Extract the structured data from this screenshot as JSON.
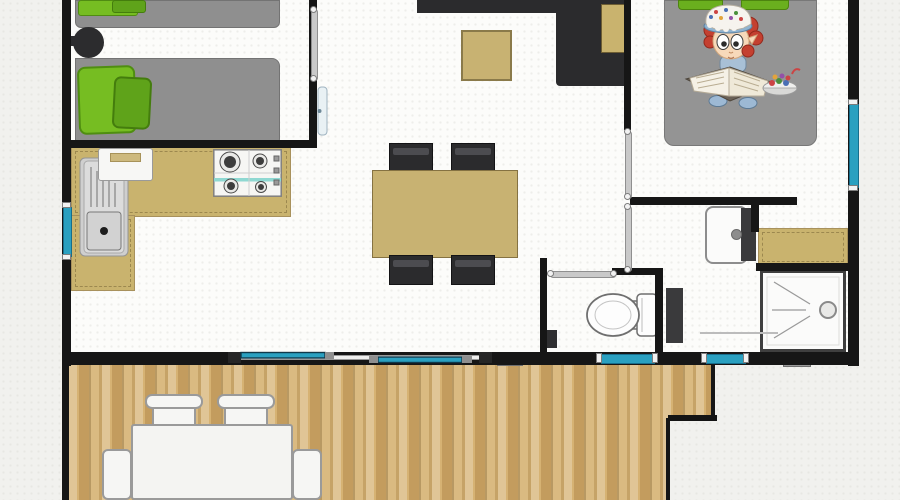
{
  "canvas": {
    "w": 900,
    "h": 500,
    "background": "#f1f1ee"
  },
  "palette": {
    "wall": "#161616",
    "floor": "#fcfcfa",
    "counter_tan": "#c9b36e",
    "table_tan": "#c8b272",
    "sofa_dark": "#2b2b2d",
    "bed_gray": "#8f8f8f",
    "pillow_green": "#76bd22",
    "pillow_green_dark": "#5fa31a",
    "window_cyan": "#2aa0c0",
    "deck_wood": "#d6b273",
    "fixture_white": "#fbfbfa",
    "fixture_dark": "#3a3a3c"
  },
  "layers": [
    {
      "name": "floor",
      "items": [
        {
          "n": "interior-floor",
          "t": "rect",
          "x": 66,
          "y": 0,
          "w": 786,
          "h": 358,
          "cls": "floor"
        }
      ]
    },
    {
      "name": "furniture",
      "items": [
        {
          "n": "kitchen-counter-top",
          "t": "rect",
          "x": 71,
          "y": 147,
          "w": 220,
          "h": 70,
          "c": "#c9b36e",
          "b": "1px solid #a8915c",
          "cls": "dashes"
        },
        {
          "n": "kitchen-counter-left",
          "t": "rect",
          "x": 71,
          "y": 215,
          "w": 64,
          "h": 76,
          "c": "#c9b36e",
          "b": "1px solid #a8915c",
          "cls": "dashes"
        },
        {
          "n": "kitchen-sink",
          "t": "sink",
          "x": 79,
          "y": 157,
          "w": 50,
          "h": 100
        },
        {
          "n": "kitchen-cabinet-white",
          "t": "appliance",
          "x": 98,
          "y": 148,
          "w": 55,
          "h": 33,
          "c": "#f7f7f5",
          "b": "1px solid #9a9a9a",
          "r": "3px"
        },
        {
          "n": "gas-hob",
          "t": "stove",
          "x": 213,
          "y": 149,
          "w": 69,
          "h": 48
        },
        {
          "n": "dining-chair-1",
          "t": "chair",
          "x": 389,
          "y": 143,
          "w": 44,
          "h": 30
        },
        {
          "n": "dining-chair-2",
          "t": "chair",
          "x": 451,
          "y": 143,
          "w": 44,
          "h": 30
        },
        {
          "n": "dining-table",
          "t": "rect",
          "x": 372,
          "y": 170,
          "w": 146,
          "h": 88,
          "c": "#c8b272",
          "b": "1px solid #857242"
        },
        {
          "n": "dining-chair-3",
          "t": "chair",
          "x": 389,
          "y": 255,
          "w": 44,
          "h": 30
        },
        {
          "n": "dining-chair-4",
          "t": "chair",
          "x": 451,
          "y": 255,
          "w": 44,
          "h": 30
        },
        {
          "n": "sofa-back",
          "t": "rect",
          "x": 417,
          "y": 0,
          "w": 214,
          "h": 13,
          "c": "#2b2b2d",
          "cls": "speckle-dark"
        },
        {
          "n": "sofa-chaise",
          "t": "rect",
          "x": 556,
          "y": 11,
          "w": 75,
          "h": 75,
          "c": "#2b2b2d",
          "cls": "speckle-dark",
          "r": "0 0 0 4px"
        },
        {
          "n": "sofa-side-table",
          "t": "rect",
          "x": 601,
          "y": 4,
          "w": 29,
          "h": 49,
          "c": "#c9b36e",
          "b": "1px solid #6d5d33"
        },
        {
          "n": "coffee-table",
          "t": "rect",
          "x": 461,
          "y": 30,
          "w": 51,
          "h": 51,
          "c": "#c8b272",
          "b": "2px solid #8a7a4a"
        },
        {
          "n": "bed-single-top",
          "t": "rect",
          "x": 75,
          "y": 0,
          "w": 205,
          "h": 28,
          "c": "#8f8f8f",
          "b": "1px solid #737373",
          "r": "0 0 6px 6px",
          "cls": "speckle-gray"
        },
        {
          "n": "pillow-top-a",
          "t": "rect",
          "x": 78,
          "y": 0,
          "w": 60,
          "h": 16,
          "c": "#76bd22",
          "b": "1px solid #508c12",
          "r": "3px"
        },
        {
          "n": "pillow-top-b",
          "t": "rect",
          "x": 112,
          "y": 0,
          "w": 34,
          "h": 13,
          "c": "#5fa31a",
          "b": "1px solid #447d0d",
          "r": "3px"
        },
        {
          "n": "bedside-stool-arm",
          "t": "rect",
          "x": 66,
          "y": 36,
          "w": 10,
          "h": 10,
          "c": "#2c2c2e"
        },
        {
          "n": "bedside-stool",
          "t": "rect",
          "x": 73,
          "y": 27,
          "w": 31,
          "h": 31,
          "c": "#2c2c2e",
          "r": "50%",
          "cls": "speckle-dark"
        },
        {
          "n": "bed-single-bottom",
          "t": "rect",
          "x": 75,
          "y": 58,
          "w": 205,
          "h": 89,
          "c": "#8f8f8f",
          "b": "1px solid #737373",
          "r": "0 8px 8px 0",
          "cls": "speckle-gray"
        },
        {
          "n": "pillow-bottom-a",
          "t": "rect",
          "x": 78,
          "y": 66,
          "w": 58,
          "h": 68,
          "c": "#76bd22",
          "b": "2px solid #4f8e10",
          "r": "8px",
          "rot": -2
        },
        {
          "n": "pillow-bottom-b",
          "t": "rect",
          "x": 113,
          "y": 77,
          "w": 38,
          "h": 52,
          "c": "#5fa31a",
          "b": "2px solid #447d0d",
          "r": "7px",
          "rot": 3
        },
        {
          "n": "bed-double",
          "t": "rect",
          "x": 664,
          "y": 0,
          "w": 153,
          "h": 146,
          "c": "#949494",
          "b": "1px solid #787878",
          "r": "0 0 10px 10px",
          "cls": "speckle-gray"
        },
        {
          "n": "pillow-double-a",
          "t": "rect",
          "x": 678,
          "y": 0,
          "w": 45,
          "h": 10,
          "c": "#6aaf1e",
          "b": "1px solid #4d840f",
          "r": "0 0 4px 4px"
        },
        {
          "n": "pillow-double-b",
          "t": "rect",
          "x": 741,
          "y": 0,
          "w": 48,
          "h": 10,
          "c": "#6aaf1e",
          "b": "1px solid #4d840f",
          "r": "0 0 4px 4px"
        },
        {
          "n": "washbasin",
          "t": "rect",
          "x": 705,
          "y": 206,
          "w": 43,
          "h": 58,
          "c": "#fbfbfa",
          "b": "2px solid #8d8d8d",
          "r": "8px"
        },
        {
          "n": "washbasin-vanity",
          "t": "rect",
          "x": 741,
          "y": 208,
          "w": 15,
          "h": 53,
          "c": "#3a3a3c"
        },
        {
          "n": "washbasin-tap",
          "t": "rect",
          "x": 731,
          "y": 229,
          "w": 11,
          "h": 11,
          "c": "#8d8d8d",
          "r": "50%",
          "b": "1px solid #6a6a6a"
        },
        {
          "n": "bathroom-counter",
          "t": "rect",
          "x": 758,
          "y": 228,
          "w": 90,
          "h": 38,
          "c": "#c9b36e",
          "b": "1px solid #a8915c",
          "cls": "dashes"
        },
        {
          "n": "shower",
          "t": "shower",
          "x": 760,
          "y": 270,
          "w": 86,
          "h": 82
        },
        {
          "n": "bathroom-cabinet",
          "t": "rect",
          "x": 666,
          "y": 288,
          "w": 17,
          "h": 55,
          "c": "#3a3a3c"
        },
        {
          "n": "bath-mat-line",
          "t": "rect",
          "x": 700,
          "y": 332,
          "w": 78,
          "h": 2,
          "c": "#bcbcbc"
        },
        {
          "n": "toilet",
          "t": "toilet",
          "x": 584,
          "y": 292,
          "w": 76,
          "h": 46
        },
        {
          "n": "wc-bin",
          "t": "rect",
          "x": 542,
          "y": 330,
          "w": 15,
          "h": 18,
          "c": "#2f2f31"
        }
      ]
    },
    {
      "name": "deck",
      "items": [
        {
          "n": "deck-upper",
          "t": "rect",
          "x": 69,
          "y": 365,
          "w": 646,
          "h": 55,
          "cls": "wood deck-right-border"
        },
        {
          "n": "deck-lower",
          "t": "rect",
          "x": 69,
          "y": 418,
          "w": 601,
          "h": 82,
          "cls": "wood deck-right-border"
        },
        {
          "n": "deck-step-edge",
          "t": "rect",
          "x": 668,
          "y": 415,
          "w": 49,
          "h": 6,
          "c": "#141414"
        },
        {
          "n": "deck-sill-a",
          "t": "rect",
          "x": 497,
          "y": 359,
          "w": 26,
          "h": 7,
          "c": "#9a9a9a",
          "b": "1px solid #6f6f6f"
        },
        {
          "n": "deck-sill-b",
          "t": "rect",
          "x": 783,
          "y": 360,
          "w": 28,
          "h": 7,
          "c": "#9a9a9a",
          "b": "1px solid #6f6f6f"
        },
        {
          "n": "patio-chair-back-1",
          "t": "rect",
          "x": 145,
          "y": 394,
          "w": 58,
          "h": 15,
          "c": "#f6f6f4",
          "b": "2px solid #9a9a9a",
          "r": "7px"
        },
        {
          "n": "patio-chair-seat-1",
          "t": "rect",
          "x": 152,
          "y": 407,
          "w": 44,
          "h": 20,
          "c": "#f6f6f4",
          "b": "2px solid #9a9a9a",
          "r": "2px"
        },
        {
          "n": "patio-chair-back-2",
          "t": "rect",
          "x": 217,
          "y": 394,
          "w": 58,
          "h": 15,
          "c": "#f6f6f4",
          "b": "2px solid #9a9a9a",
          "r": "7px"
        },
        {
          "n": "patio-chair-seat-2",
          "t": "rect",
          "x": 224,
          "y": 407,
          "w": 44,
          "h": 20,
          "c": "#f6f6f4",
          "b": "2px solid #9a9a9a",
          "r": "2px"
        },
        {
          "n": "patio-chair-left",
          "t": "rect",
          "x": 102,
          "y": 449,
          "w": 30,
          "h": 51,
          "c": "#f6f6f4",
          "b": "2px solid #9a9a9a",
          "r": "6px"
        },
        {
          "n": "patio-chair-right",
          "t": "rect",
          "x": 292,
          "y": 449,
          "w": 30,
          "h": 51,
          "c": "#f6f6f4",
          "b": "2px solid #9a9a9a",
          "r": "6px"
        },
        {
          "n": "patio-table",
          "t": "rect",
          "x": 131,
          "y": 424,
          "w": 162,
          "h": 76,
          "c": "#f4f4f2",
          "b": "2px solid #9a9a9a",
          "r": "3px"
        }
      ]
    },
    {
      "name": "walls",
      "items": [
        {
          "n": "wall-left",
          "t": "wall",
          "x": 62,
          "y": 0,
          "w": 9,
          "h": 366
        },
        {
          "n": "wall-right",
          "t": "wall",
          "x": 848,
          "y": 0,
          "w": 11,
          "h": 366
        },
        {
          "n": "wall-bottom",
          "t": "wall",
          "x": 62,
          "y": 352,
          "w": 797,
          "h": 13
        },
        {
          "n": "wall-bedroom1-south",
          "t": "wall",
          "x": 62,
          "y": 140,
          "w": 252,
          "h": 8
        },
        {
          "n": "wall-bedroom1-east",
          "t": "wall",
          "x": 309,
          "y": 0,
          "w": 8,
          "h": 148
        },
        {
          "n": "wall-living-east",
          "t": "wall",
          "x": 624,
          "y": 0,
          "w": 7,
          "h": 130
        },
        {
          "n": "wall-bedroom2-south",
          "t": "wall",
          "x": 630,
          "y": 197,
          "w": 167,
          "h": 8
        },
        {
          "n": "wall-bath-stub",
          "t": "wall",
          "x": 751,
          "y": 197,
          "w": 8,
          "h": 35
        },
        {
          "n": "wall-bath-mid",
          "t": "wall",
          "x": 756,
          "y": 263,
          "w": 92,
          "h": 8
        },
        {
          "n": "wall-wc-left",
          "t": "wall",
          "x": 540,
          "y": 258,
          "w": 7,
          "h": 95
        },
        {
          "n": "wall-wc-top",
          "t": "wall",
          "x": 612,
          "y": 268,
          "w": 50,
          "h": 7
        },
        {
          "n": "wall-wc-right",
          "t": "wall",
          "x": 655,
          "y": 268,
          "w": 8,
          "h": 85
        },
        {
          "n": "deck-left-edge",
          "t": "wall",
          "x": 62,
          "y": 366,
          "w": 7,
          "h": 134
        }
      ]
    },
    {
      "name": "openings",
      "items": [
        {
          "n": "door-slide-bedroom1",
          "t": "slide-v",
          "x": 309,
          "y": 6,
          "w": 8,
          "h": 76
        },
        {
          "n": "door-leaf-bedroom1",
          "t": "leaf",
          "x": 317,
          "y": 86,
          "w": 11,
          "h": 50
        },
        {
          "n": "door-slide-living-a",
          "t": "slide-v",
          "x": 624,
          "y": 128,
          "w": 7,
          "h": 72
        },
        {
          "n": "door-slide-living-b",
          "t": "slide-v",
          "x": 624,
          "y": 203,
          "w": 7,
          "h": 70
        },
        {
          "n": "door-slide-wc",
          "t": "slide-h",
          "x": 547,
          "y": 269,
          "w": 70,
          "h": 8
        },
        {
          "n": "window-left",
          "t": "win-v",
          "x": 62,
          "y": 202,
          "w": 9,
          "h": 58
        },
        {
          "n": "window-right",
          "t": "win-v",
          "x": 848,
          "y": 99,
          "w": 10,
          "h": 92
        },
        {
          "n": "window-wc",
          "t": "win-h",
          "x": 596,
          "y": 353,
          "w": 62,
          "h": 10
        },
        {
          "n": "window-bath",
          "t": "win-h",
          "x": 701,
          "y": 353,
          "w": 48,
          "h": 10
        },
        {
          "n": "patio-sliding-door",
          "t": "patio-door",
          "x": 228,
          "y": 350,
          "w": 264,
          "h": 15
        }
      ]
    },
    {
      "name": "decor",
      "items": [
        {
          "n": "reading-child-illustration",
          "t": "clipart",
          "x": 668,
          "y": 4,
          "w": 135,
          "h": 114
        }
      ]
    }
  ]
}
